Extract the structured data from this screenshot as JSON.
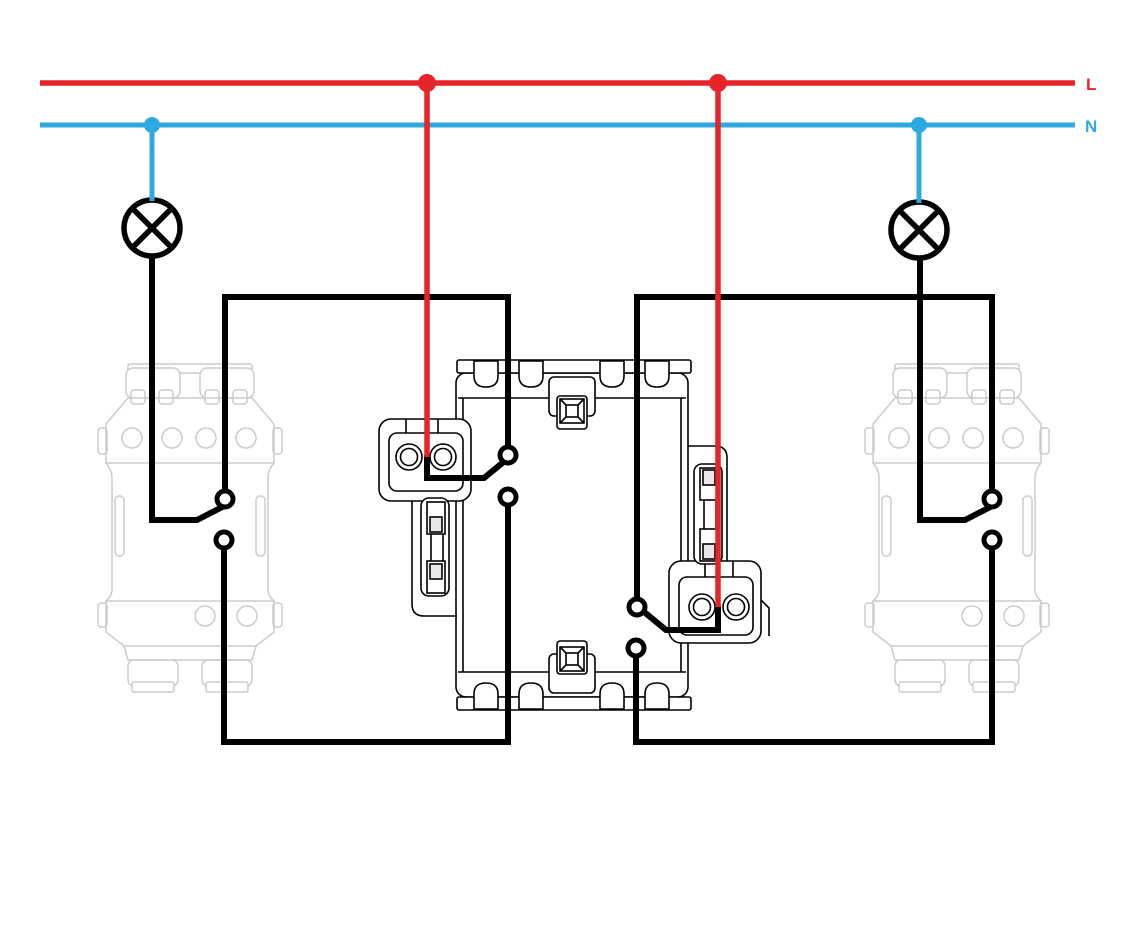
{
  "diagram": {
    "labels": {
      "live": "L",
      "neutral": "N"
    },
    "colors": {
      "live": "#e62429",
      "neutral": "#2ea9e0",
      "wire": "#000000",
      "mechanism_outline": "#cccccc"
    },
    "components": {
      "lamp_count": 2,
      "wall_switch_count": 2,
      "live_junction_dots": 2,
      "neutral_junction_dots": 2,
      "central_insert": "double switch insert with two 2-hole terminal blocks and claw frame"
    }
  }
}
